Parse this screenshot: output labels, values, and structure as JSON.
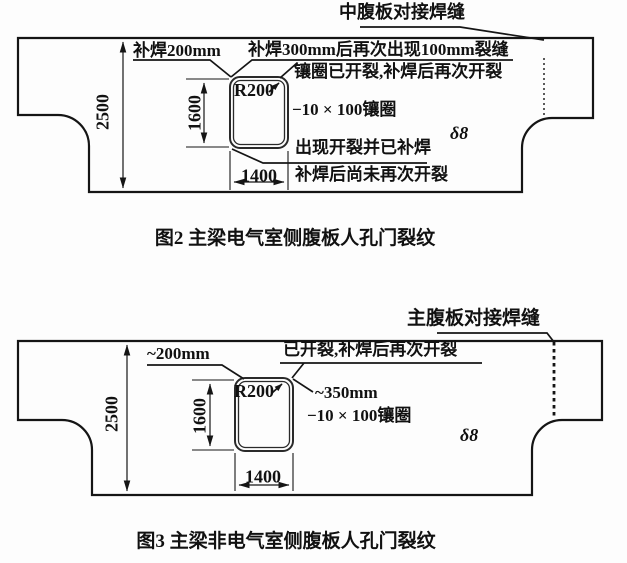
{
  "figure2": {
    "weld_seam_label": "中腹板对接焊缝",
    "note_repair_200": "补焊200mm",
    "note_repair_300": "补焊300mm后再次出现100mm裂缝",
    "note_ring_cracked": "镶圈已开裂,补焊后再次开裂",
    "corner_radius": "R200",
    "ring_spec": "−10 × 100镶圈",
    "plate_thickness": "δ8",
    "note_crack_repaired": "出现开裂并已补焊",
    "note_no_recrack": "补焊后尚未再次开裂",
    "dim_girder_height": "2500",
    "dim_hole_height": "1600",
    "dim_hole_width": "1400",
    "caption": "图2  主梁电气室侧腹板人孔门裂纹"
  },
  "figure3": {
    "weld_seam_label": "主腹板对接焊缝",
    "note_crack_200": "~200mm",
    "note_cracked_recracked": "已开裂,补焊后再次开裂",
    "note_crack_350": "~350mm",
    "corner_radius": "R200",
    "ring_spec": "−10 × 100镶圈",
    "plate_thickness": "δ8",
    "dim_girder_height": "2500",
    "dim_hole_height": "1600",
    "dim_hole_width": "1400",
    "caption": "图3  主梁非电气室侧腹板人孔门裂纹"
  }
}
